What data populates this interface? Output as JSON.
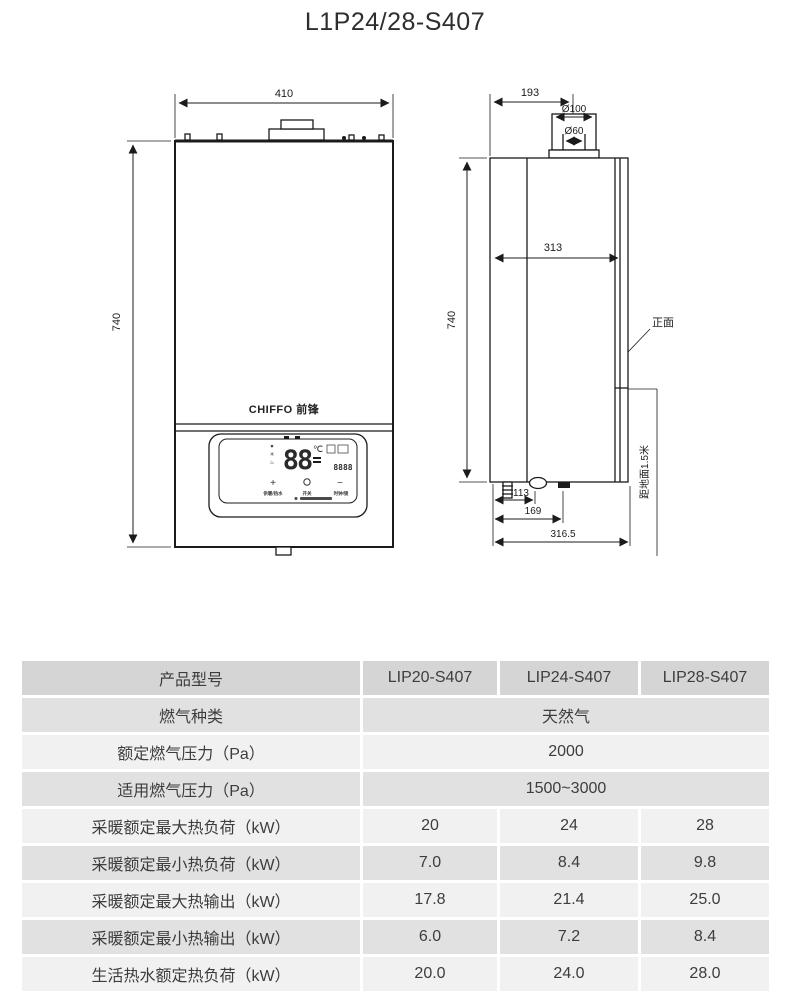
{
  "page": {
    "title": "L1P24/28-S407"
  },
  "front_view": {
    "dim_width": "410",
    "dim_height": "740",
    "brand": "CHIFFO 前锋",
    "display": {
      "temp": "88",
      "unit": "℃",
      "sub_digits": "8888",
      "btn_plus": "+",
      "btn_minus": "−",
      "label_left": "供暖/热水",
      "label_mid": "开关",
      "label_right": "时钟/锁"
    }
  },
  "side_view": {
    "dim_top": "193",
    "dim_flue_outer": "Ø100",
    "dim_flue_inner": "Ø60",
    "dim_depth": "313",
    "dim_height": "740",
    "dim_bottom1": "113",
    "dim_bottom2": "169",
    "dim_bottom3": "316.5",
    "label_front_face": "正面",
    "label_ground": "距地面1.5米"
  },
  "spec_table": {
    "rows": [
      {
        "label": "产品型号",
        "values": [
          "LIP20-S407",
          "LIP24-S407",
          "LIP28-S407"
        ]
      },
      {
        "label": "燃气种类",
        "span": "天然气"
      },
      {
        "label": "额定燃气压力（Pa）",
        "span": "2000"
      },
      {
        "label": "适用燃气压力（Pa）",
        "span": "1500~3000"
      },
      {
        "label": "采暖额定最大热负荷（kW）",
        "values": [
          "20",
          "24",
          "28"
        ]
      },
      {
        "label": "采暖额定最小热负荷（kW）",
        "values": [
          "7.0",
          "8.4",
          "9.8"
        ]
      },
      {
        "label": "采暖额定最大热输出（kW）",
        "values": [
          "17.8",
          "21.4",
          "25.0"
        ]
      },
      {
        "label": "采暖额定最小热输出（kW）",
        "values": [
          "6.0",
          "7.2",
          "8.4"
        ]
      },
      {
        "label": "生活热水额定热负荷（kW）",
        "values": [
          "20.0",
          "24.0",
          "28.0"
        ]
      }
    ]
  }
}
